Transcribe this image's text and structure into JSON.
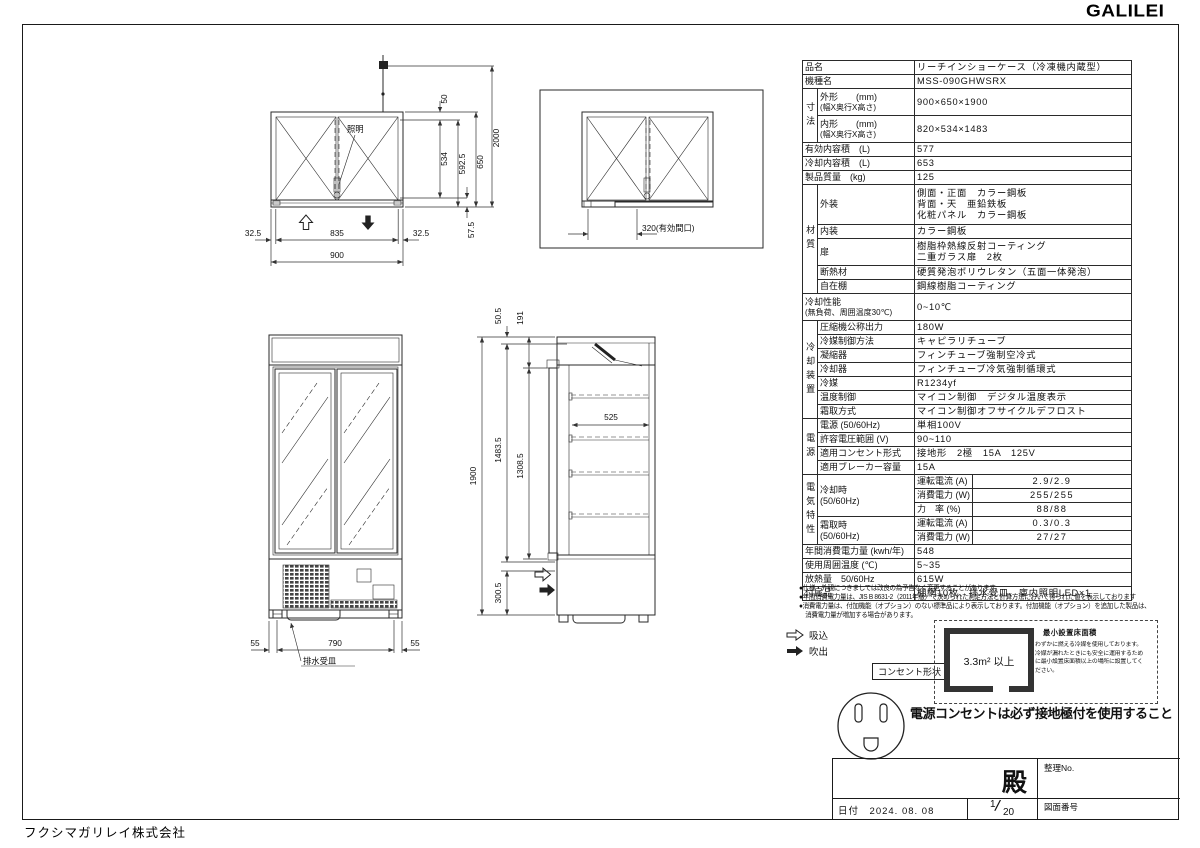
{
  "logo": "GALILEI",
  "company": "フクシマガリレイ株式会社",
  "spec": {
    "product": {
      "label": "品名",
      "value": "リーチインショーケース（冷凍機内蔵型）"
    },
    "model": {
      "label": "機種名",
      "value": "MSS-090GHWSRX"
    },
    "dim_group": "寸法",
    "outer_dim": {
      "label": "外形　　(mm)",
      "label2": "(幅X奥行X高さ)",
      "value": "900×650×1900"
    },
    "inner_dim": {
      "label": "内形　　(mm)",
      "label2": "(幅X奥行X高さ)",
      "value": "820×534×1483"
    },
    "effective_volume": {
      "label": "有効内容積　(L)",
      "value": "577"
    },
    "cooling_volume": {
      "label": "冷却内容積　(L)",
      "value": "653"
    },
    "weight": {
      "label": "製品質量　(kg)",
      "value": "125"
    },
    "material_group": "材質",
    "exterior": {
      "label": "外装",
      "value1": "側面・正面　カラー鋼板",
      "value2": "背面・天　亜鉛鉄板",
      "value3": "化粧パネル　カラー鋼板"
    },
    "interior": {
      "label": "内装",
      "value": "カラー鋼板"
    },
    "door": {
      "label": "扉",
      "value1": "樹脂枠熱線反射コーティング",
      "value2": "二重ガラス扉　2枚"
    },
    "insulation": {
      "label": "断熱材",
      "value": "硬質発泡ポリウレタン（五面一体発泡）"
    },
    "shelves": {
      "label": "自在棚",
      "value": "鋼線樹脂コーティング"
    },
    "cooling_perf": {
      "label": "冷却性能",
      "label2": "(無負荷、周囲温度30℃)",
      "value": "0~10℃"
    },
    "cooling_group": "冷却装置",
    "compressor": {
      "label": "圧縮機公称出力",
      "value": "180W"
    },
    "refrigerant_control": {
      "label": "冷媒制御方法",
      "value": "キャピラリチューブ"
    },
    "condenser": {
      "label": "凝縮器",
      "value": "フィンチューブ強制空冷式"
    },
    "cooler": {
      "label": "冷却器",
      "value": "フィンチューブ冷気強制循環式"
    },
    "refrigerant": {
      "label": "冷媒",
      "value": "R1234yf"
    },
    "temp_control": {
      "label": "温度制御",
      "value": "マイコン制御　デジタル温度表示"
    },
    "defrost": {
      "label": "霜取方式",
      "value": "マイコン制御オフサイクルデフロスト"
    },
    "power_group": "電源",
    "power_source": {
      "label": "電源 (50/60Hz)",
      "value": "単相100V"
    },
    "voltage_range": {
      "label": "許容電圧範囲 (V)",
      "value": "90~110"
    },
    "outlet_type": {
      "label": "適用コンセント形式",
      "value": "接地形　2極　15A　125V"
    },
    "breaker": {
      "label": "適用ブレーカー容量",
      "value": "15A"
    },
    "elec_group": "電気特性",
    "cooling_mode": {
      "label": "冷却時",
      "label2": "(50/60Hz)"
    },
    "cool_current": {
      "label": "運転電流 (A)",
      "value": "2.9/2.9"
    },
    "cool_power": {
      "label": "消費電力 (W)",
      "value": "255/255"
    },
    "cool_pf": {
      "label": "力　率 (%)",
      "value": "88/88"
    },
    "defrost_mode": {
      "label": "霜取時",
      "label2": "(50/60Hz)"
    },
    "def_current": {
      "label": "運転電流 (A)",
      "value": "0.3/0.3"
    },
    "def_power": {
      "label": "消費電力 (W)",
      "value": "27/27"
    },
    "annual_energy": {
      "label": "年間消費電力量 (kwh/年)",
      "value": "548"
    },
    "ambient_temp": {
      "label": "使用周囲温度 (℃)",
      "value": "5~35"
    },
    "heat_output": {
      "label": "放熱量　50/60Hz",
      "value": "615W"
    },
    "accessories": {
      "label": "付属品",
      "value": "棚網10枚、排水受皿、庫内照明LED×1"
    }
  },
  "notes": {
    "line1": "●仕様・外観につきましては改良の為予告なく変更することがあります。",
    "line2": "●年間消費電力量は、JIS B 8631-2（2011年版）で決められた測定方法と計算方法において得られた値を表示しております",
    "line3": "●消費電力量は、付加機能（オプション）のない標準品により表示しております。付加機能（オプション）を追加した製品は、",
    "line4": "　消費電力量が増加する場合があります。"
  },
  "airflow": {
    "suction": "吸込",
    "blowout": "吹出"
  },
  "outlet": {
    "shape_label": "コンセント形状"
  },
  "warning": "電源コンセントは必ず接地極付を使用すること",
  "min_area": {
    "title": "最小設置床面積",
    "value": "3.3m² 以上",
    "desc1": "わずかに燃える冷媒を使用しております。",
    "desc2": "冷媒が漏れたときにも安全に運用するため",
    "desc3": "に最小設置床面積以上の場所に設置してく",
    "desc4": "ださい。"
  },
  "title_block": {
    "honorific": "殿",
    "ref_label": "整理No.",
    "date_label": "日付",
    "date": "2024. 08. 08",
    "sheet_no": "1",
    "sheet_total": "20",
    "drawing_no_label": "図面番号"
  },
  "plan_view": {
    "light": "照明",
    "d2000": "2000",
    "d50": "50",
    "d534": "534",
    "d5925": "592.5",
    "d650": "650",
    "d575": "57.5",
    "d325l": "32.5",
    "d835": "835",
    "d325r": "32.5",
    "d900": "900"
  },
  "open_view": {
    "d320": "320(有効間口)"
  },
  "front_view": {
    "d55l": "55",
    "d790": "790",
    "d55r": "55",
    "drain": "排水受皿"
  },
  "side_view": {
    "d505": "50.5",
    "d191": "191",
    "d1900": "1900",
    "d14835": "1483.5",
    "d13085": "1308.5",
    "d525": "525",
    "d3005": "300.5"
  }
}
